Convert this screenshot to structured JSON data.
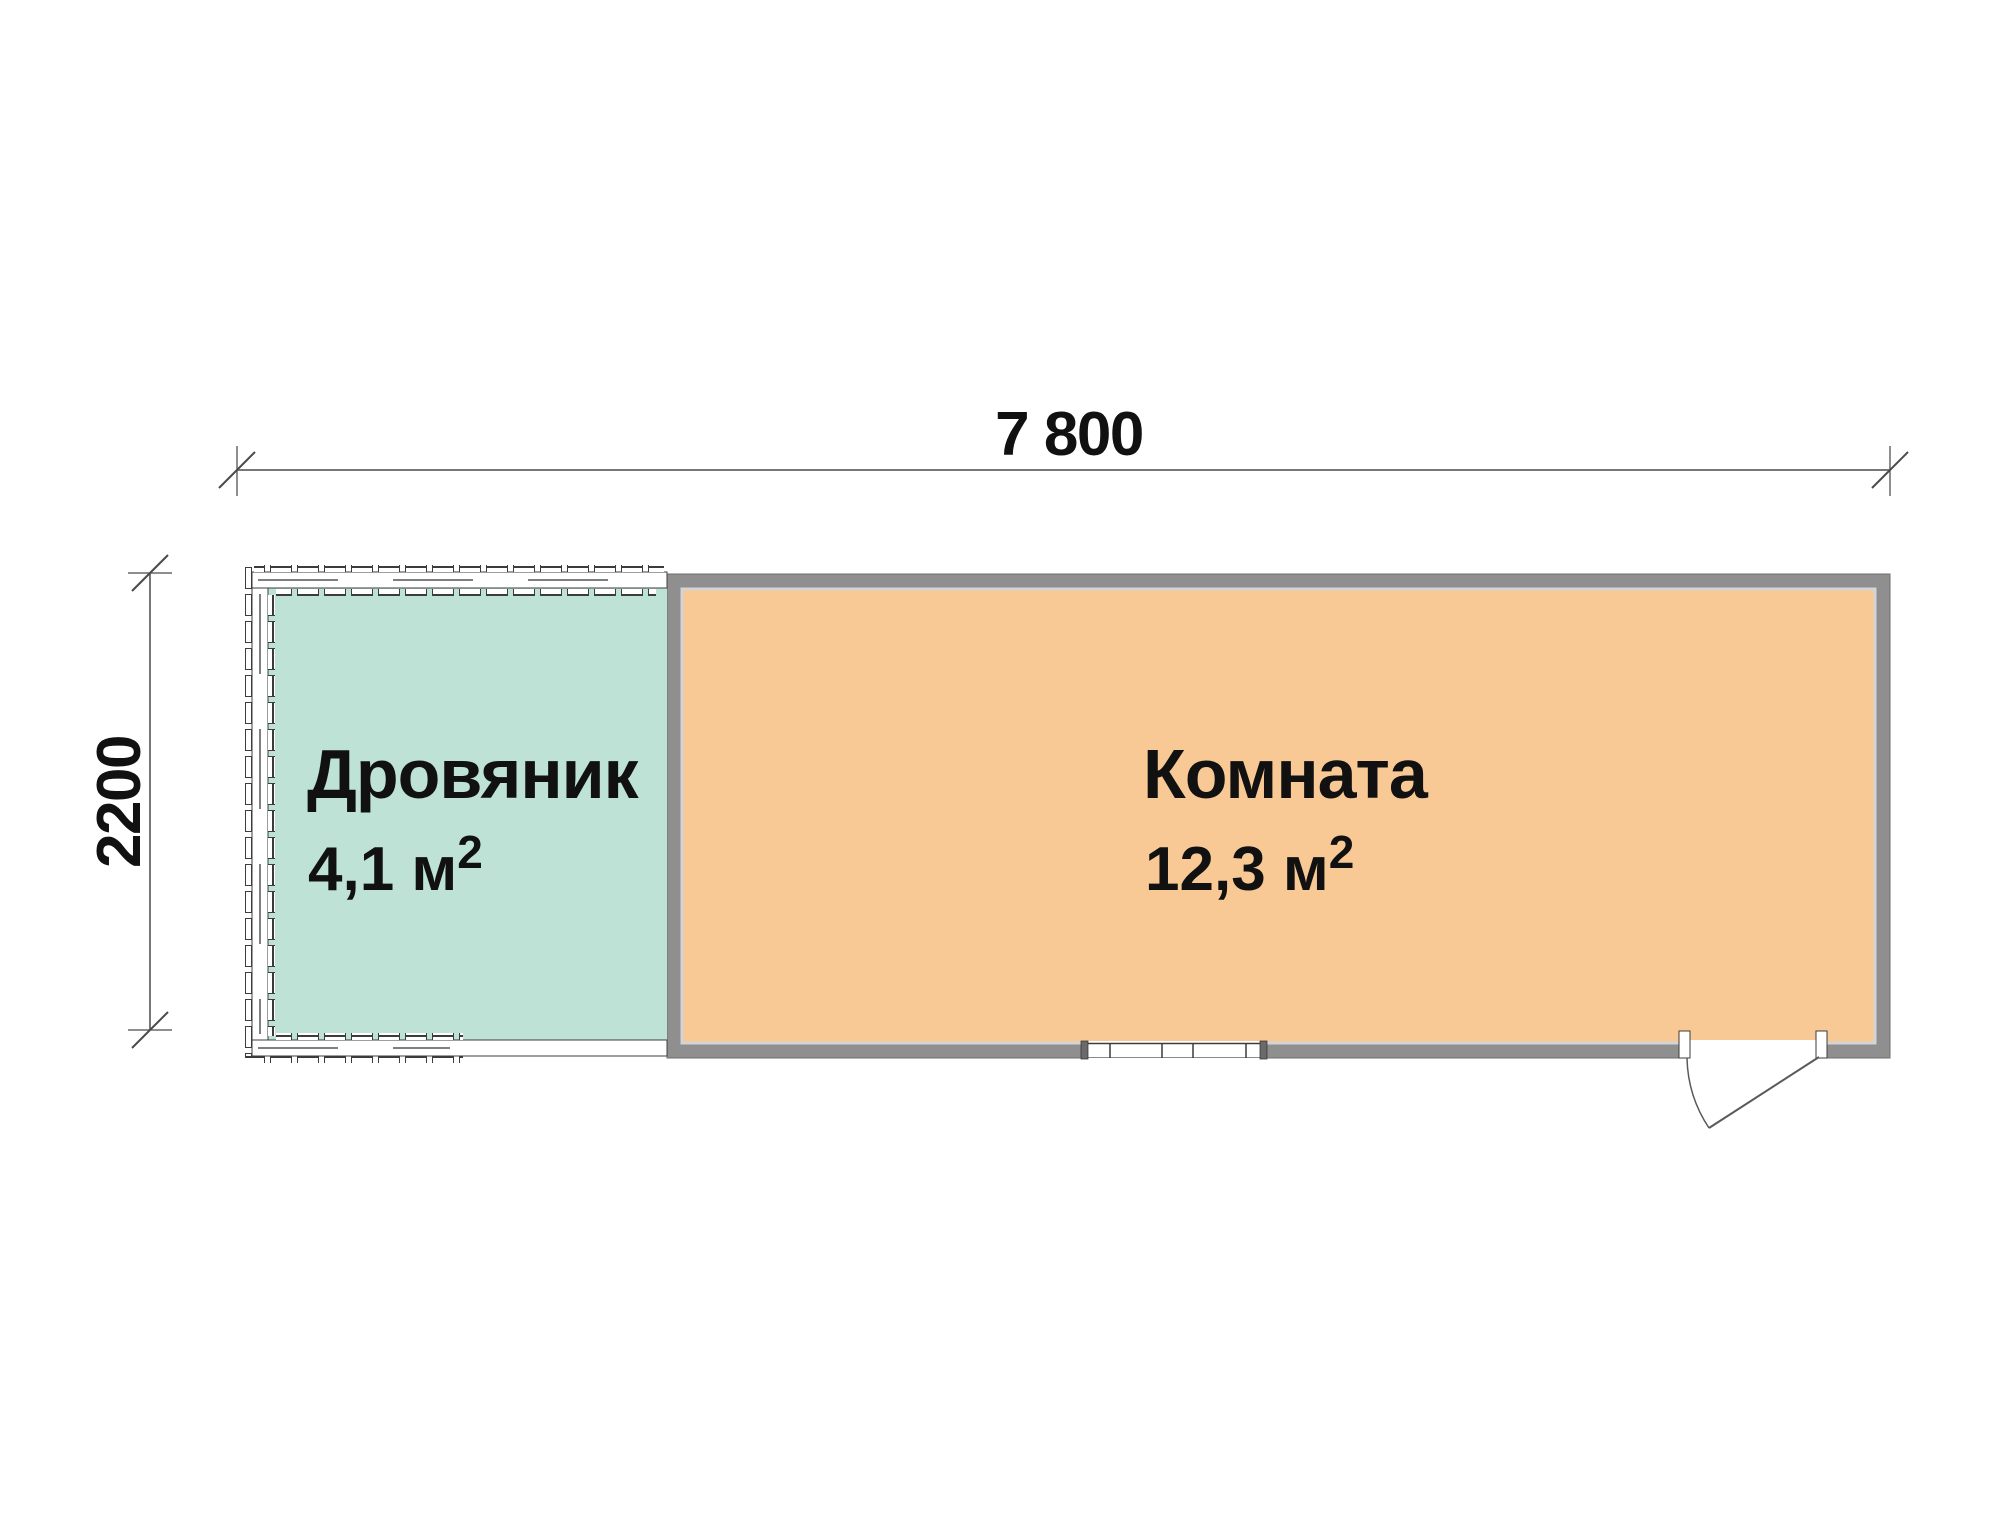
{
  "plan": {
    "dimensions": {
      "width_label": "7 800",
      "height_label": "2200"
    },
    "rooms": [
      {
        "label": "Дровяник",
        "area": "4,1 м",
        "area_sup": "2",
        "fill": "#bee2d6"
      },
      {
        "label": "Комната",
        "area": "12,3 м",
        "area_sup": "2",
        "fill": "#f8c994"
      }
    ],
    "elements": {
      "door": "entrance-door-swing",
      "window": "window-opening"
    },
    "colors": {
      "wall_gray": "#8f8f8f",
      "wall_edge": "#6f6f6f",
      "inner_trim": "#d4d4d4",
      "line_dark": "#3c3c3c",
      "dim_line": "#4a4a4a",
      "background": "#ffffff"
    }
  }
}
